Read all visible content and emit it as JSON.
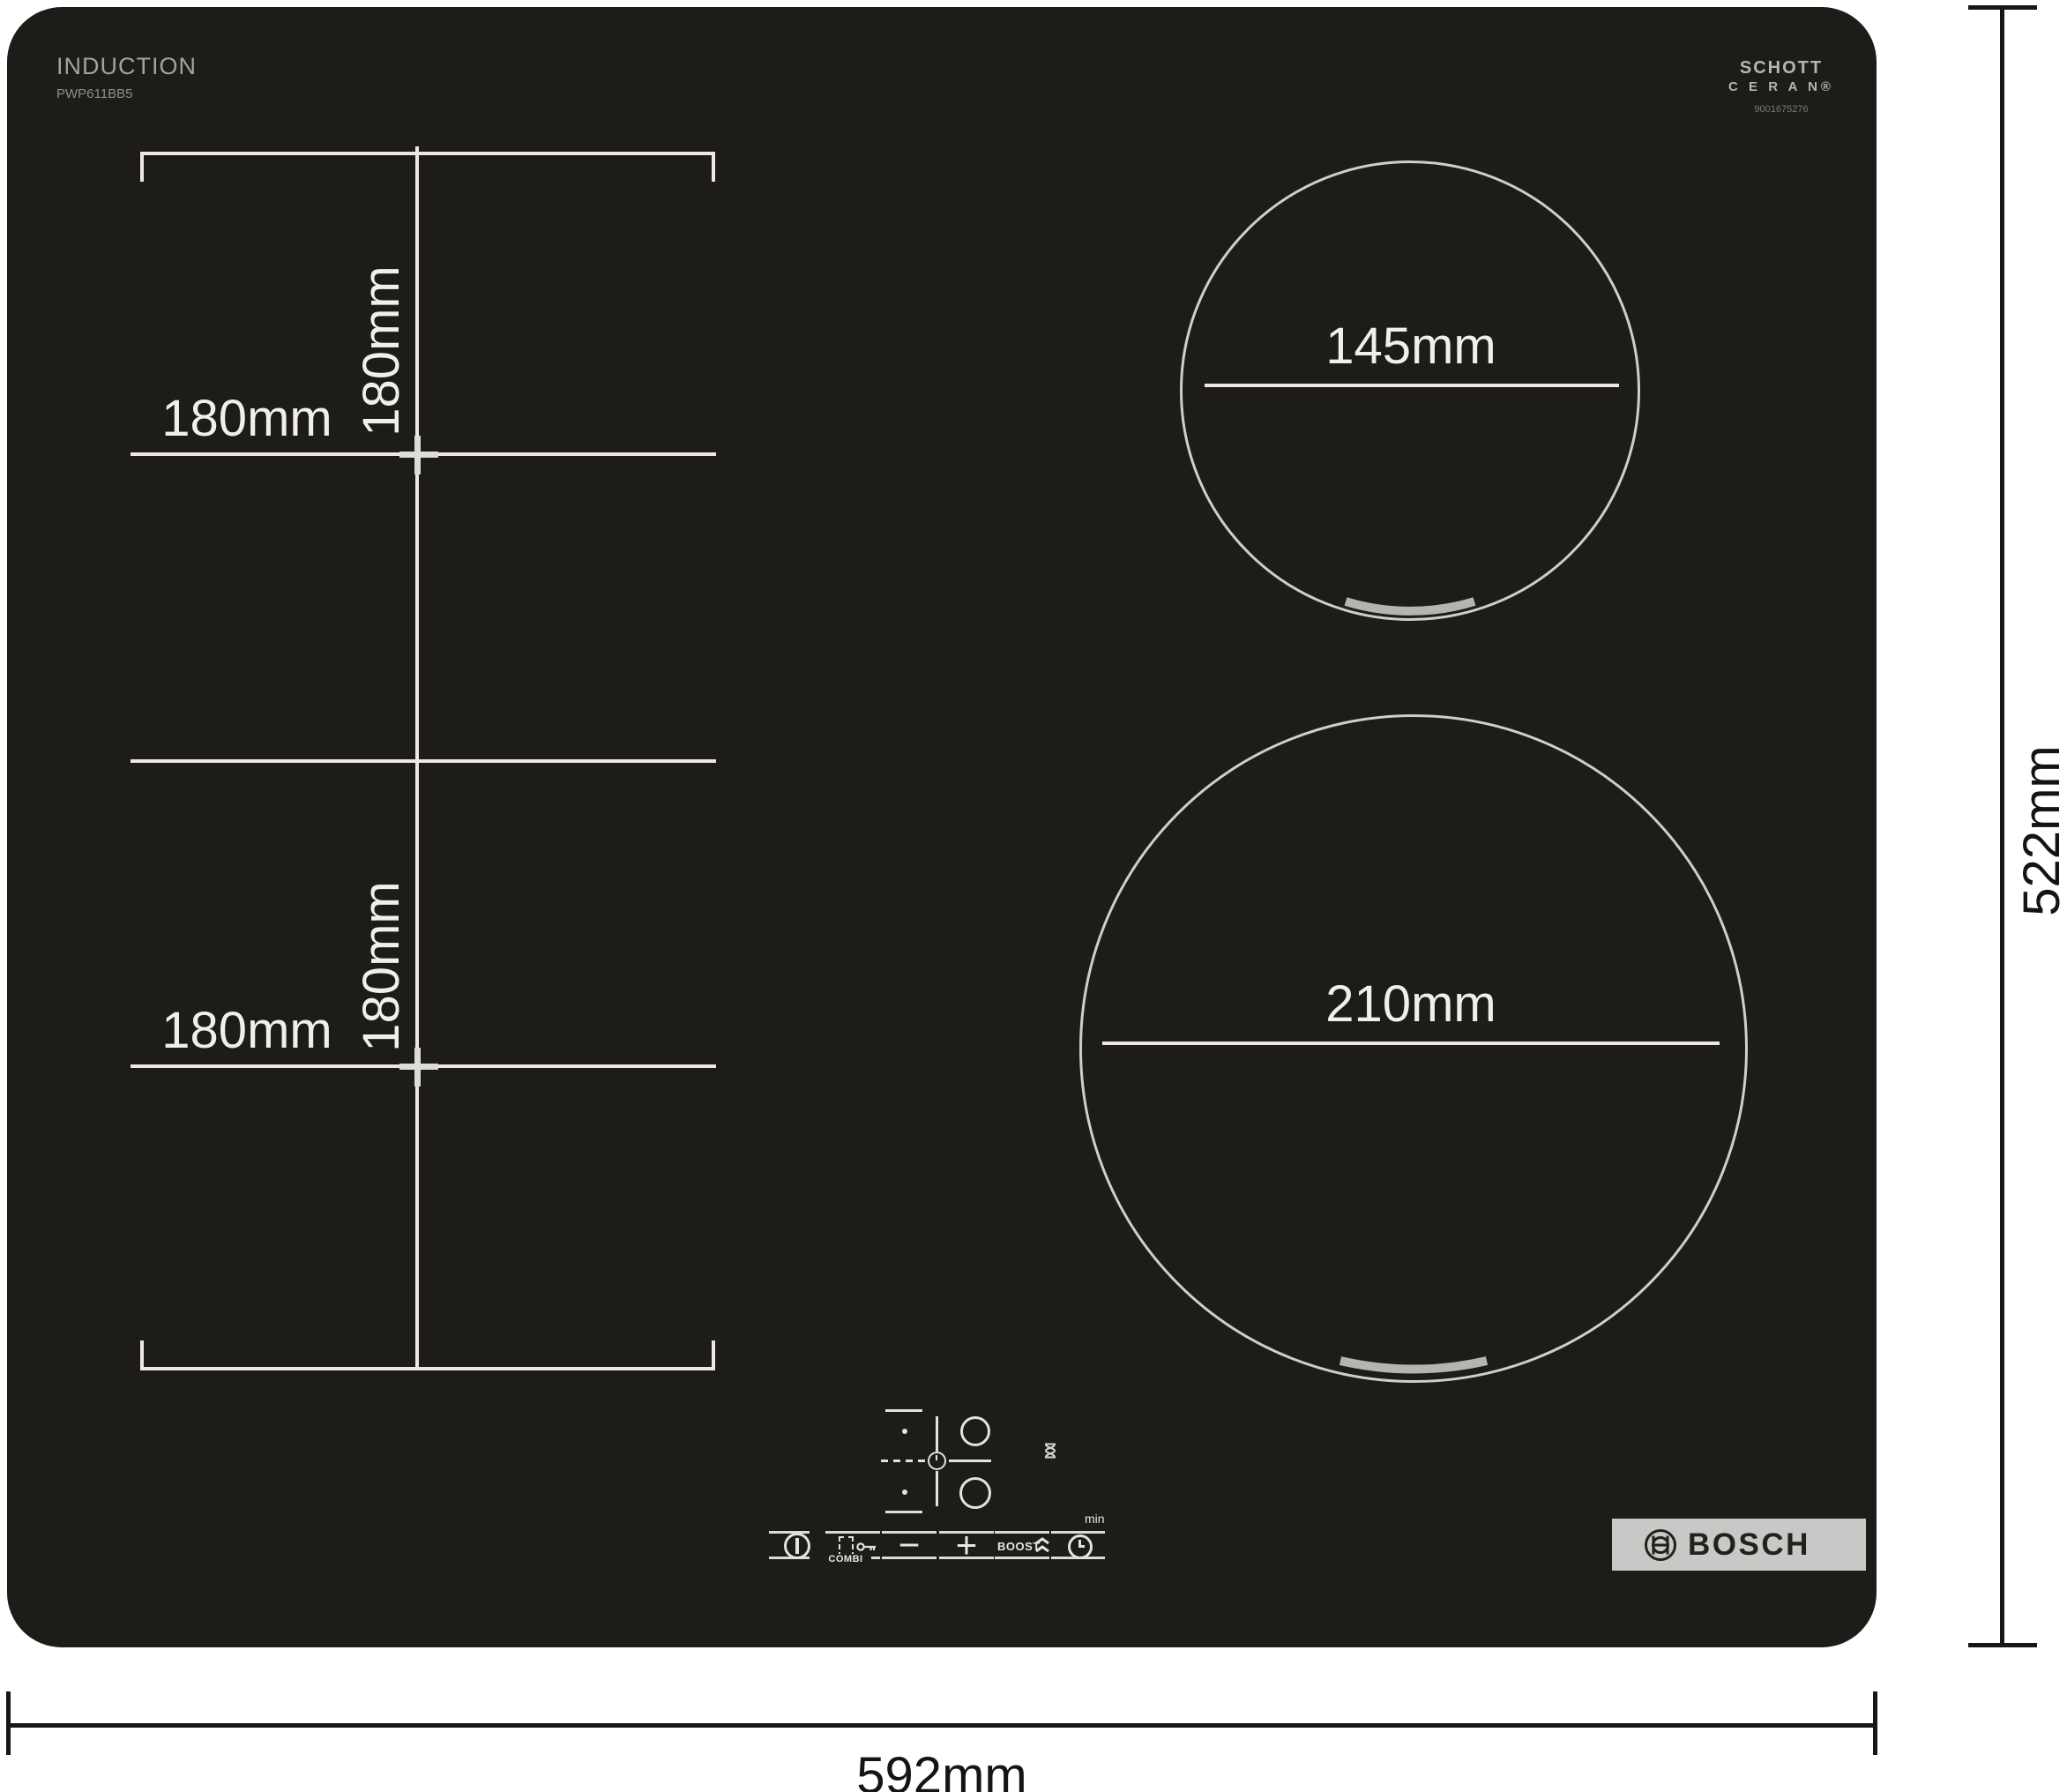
{
  "branding": {
    "type_label": "INDUCTION",
    "model": "PWP611BB5",
    "glass_line1": "SCHOTT",
    "glass_line2": "C E R A N®",
    "glass_code": "9001675276",
    "logo_text": "BOSCH"
  },
  "zone_dimensions": {
    "flex_top_width": "180mm",
    "flex_top_depth": "180mm",
    "flex_bottom_width": "180mm",
    "flex_bottom_depth": "180mm",
    "small_burner_diameter": "145mm",
    "large_burner_diameter": "210mm"
  },
  "overall_dimensions": {
    "width": "592mm",
    "depth": "522mm"
  },
  "control_labels": {
    "combi": "COMBI",
    "boost": "BOOST",
    "minutes_unit": "min",
    "minus": "−",
    "plus": "+"
  },
  "colors": {
    "hob_glass": "#1e1c18",
    "marking_white": "#ece9e4",
    "circle_stroke": "#cfcecb",
    "arc_gray": "#b5b4b1",
    "badge_silver": "#c8c8c6",
    "dimension_black": "#161616"
  }
}
